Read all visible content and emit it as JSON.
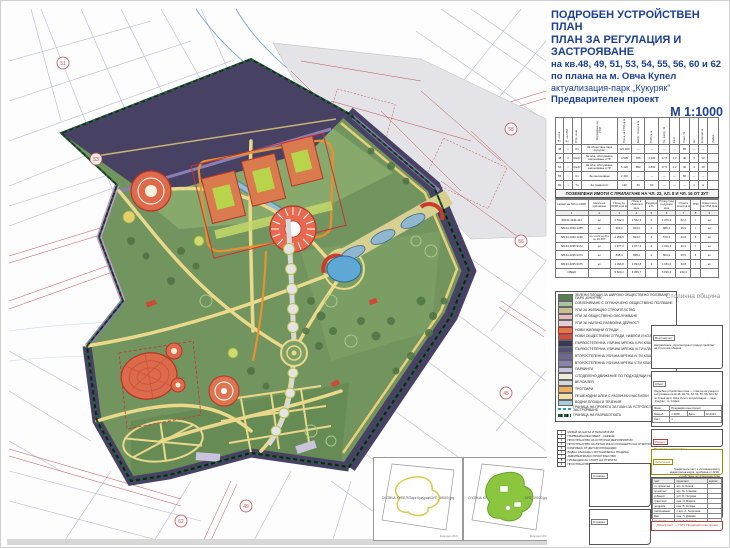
{
  "header": {
    "title_line1": "ПОДРОБЕН УСТРОЙСТВЕН ПЛАН",
    "title_line2": "ПЛАН ЗА РЕГУЛАЦИЯ И ЗАСТРОЯВАНЕ",
    "sub1": "на кв.48, 49, 51, 53, 54, 55, 56, 60 и 62",
    "sub2": "по плана на м. Овча Купел",
    "sub3": "актуализация-парк „Кукуряк“",
    "sub4": "Предварителен проект",
    "scale": "М 1:1000"
  },
  "municipality": "Столична община",
  "table1": {
    "headers": [
      "№ на кв.",
      "№ на УПИ",
      "Устр. зона",
      "Отреждане на УПИ",
      "Площ на УПИ кв.м",
      "Застр. площ кв.м",
      "РЗП кв.м",
      "Пл. застр. %",
      "Кинт",
      "Озел. %",
      "Ет.",
      "Н корниз м",
      "Забел."
    ],
    "rows": [
      [
        "48",
        "I",
        "Оз",
        "За обществен парк „Кукуряк“",
        "122 460",
        "—",
        "—",
        "—",
        "—",
        "85",
        "—",
        "—",
        ""
      ],
      [
        "48",
        "II",
        "Смф*",
        "За общ. обслужване, озеленяване и ПГ",
        "4 505",
        "785",
        "4 320",
        "17,5",
        "1,2",
        "40",
        "3",
        "10",
        ""
      ],
      [
        "54",
        "I",
        "Смф*",
        "За общ. обслужване, озеленяване и ПГ",
        "5 120",
        "890",
        "4 860",
        "17,5",
        "1,2",
        "40",
        "3",
        "10",
        ""
      ],
      [
        "55",
        "I",
        "Оз",
        "За озеленяване",
        "2 410",
        "—",
        "—",
        "—",
        "—",
        "80",
        "—",
        "—",
        ""
      ],
      [
        "60",
        "I",
        "Тп",
        "За трафопост",
        "120",
        "60",
        "60",
        "—",
        "—",
        "—",
        "1",
        "4",
        ""
      ],
      [
        "62",
        "I",
        "Оз",
        "За озеленяване и техн. инфраструктура",
        "980",
        "—",
        "—",
        "—",
        "—",
        "80",
        "—",
        "—",
        ""
      ]
    ]
  },
  "table2": {
    "title": "ПОЗЕМЛЕНИ ИМОТИ С ПРИЛАГАНЕ НА ЧЛ. 22, АЛ. 8 И ЧЛ. 16 ОТ ЗУТ",
    "headers": [
      "Номер на ПИ по КККР",
      "Начин на прилагане",
      "Площ по КККР в кв.м",
      "Площ в обхвата в кв.м",
      "Редукция в %",
      "Площ след редукция кв.м",
      "Отнета площ кв.м",
      "УПИ",
      "Нова площ на УПИ кв.м"
    ],
    "col_numbers": [
      "1",
      "2",
      "3",
      "4",
      "5",
      "6",
      "7",
      "8",
      "9"
    ],
    "rows": [
      [
        "68134.4334.421",
        "нл",
        "1 532,3",
        "1 532,3",
        "4",
        "1 470,1",
        "62,2",
        "I",
        "нл"
      ],
      [
        "68134.4334.1385",
        "нл",
        "923,0",
        "923,0",
        "4",
        "886,1",
        "36,9",
        "I",
        "нл"
      ],
      [
        "68134.4334.1249",
        "по чл.22 ал.8 и чл.16 ЗУТ",
        "4 354,5",
        "594,0",
        "4",
        "570,2",
        "23,8",
        "II",
        "нл"
      ],
      [
        "68134.4335.9472",
        "нл",
        "1 077,2",
        "1 077,2",
        "4",
        "1 034,1",
        "43,1",
        "I",
        "нл"
      ],
      [
        "68134.4335.9474",
        "нл",
        "838,4",
        "838,4",
        "4",
        "804,9",
        "33,5",
        "II",
        "нл"
      ],
      [
        "68134.4335.9475",
        "нл",
        "1 094,8",
        "1 094,8",
        "4",
        "1 051,0",
        "43,8",
        "I",
        "нл"
      ],
      [
        "ОБЩО",
        "",
        "9 820,2",
        "6 059,7",
        "",
        "5 816,4",
        "243,3",
        "",
        ""
      ]
    ]
  },
  "legend": {
    "items": [
      {
        "color": "#55804f",
        "label": "ЗЕЛЕНИ ПЛОЩИ ЗА ШИРОКО ОБЩЕСТВЕНО ПОЛЗВАНЕ - ПАРК „КУКУРЯК“"
      },
      {
        "color": "#a9c6a0",
        "label": "ОЗЕЛЕНЯВАНЕ С ОГРАНИЧЕНО ОБЩЕСТВЕНО ПОЛЗВАНЕ"
      },
      {
        "color": "#cbbf92",
        "label": "УПИ ЗА ЖИЛИЩНО СТРОИТЕЛСТВО"
      },
      {
        "color": "#e7bcbc",
        "label": "УПИ ЗА ОБЩЕСТВЕНО ОБСЛУЖВАНЕ"
      },
      {
        "color": "#e3cdd9",
        "label": "УПИ ЗА НАУЧНО-РАЗВОЙНА ДЕЙНОСТ"
      },
      {
        "color": "#d97b4f",
        "style": "bordered",
        "label": "НОВИ ЖИЛИЩНИ СГРАДИ"
      },
      {
        "color": "#dd4a38",
        "label": "НОВИ ОБЩЕСТВЕНИ СГРАДИ, НАВЕСИ И КОЗИРКИ"
      },
      {
        "color": "#3c3858",
        "label": "ПЪРВОСТЕПЕННА УЛИЧНА МРЕЖА II-РИ КЛАС"
      },
      {
        "color": "#55507a",
        "label": "ПЪРВОСТЕПЕННА УЛИЧНА МРЕЖА III-ТИ КЛАС"
      },
      {
        "color": "#6f6896",
        "label": "ВТОРОСТЕПЕННА УЛИЧНА МРЕЖА IV-ТИ КЛАС"
      },
      {
        "color": "#8b84ae",
        "label": "ВТОРОСТЕПЕННА УЛИЧНА МРЕЖА V-ТИ КЛАС"
      },
      {
        "color": "#cac3de",
        "label": "ПАРКИНГИ"
      },
      {
        "color": "#f0ecdc",
        "label": "СПОДЕЛЕНО ДВИЖЕНИЕ ПО ПОДХОДЯЩИ НАСТИЛКИ"
      },
      {
        "color": "#d8d8d8",
        "label": "ВЕЛОАЛЕЯ"
      },
      {
        "color": "#f0b060",
        "label": "ТРОТОАРИ"
      },
      {
        "color": "#f2e2a8",
        "label": "ПЕШЕХОДНИ АЛЕИ С РАЗЛИЧНИ НАСТИЛКИ"
      },
      {
        "color": "#a5cfe0",
        "label": "ВОДНИ ПЛОЩИ И ТЕЧЕНИЯ"
      },
      {
        "style": "dash-teal",
        "label": "ГРАНИЦА НА ПРОЕКТА ЗА ПЛАН ЗА УСТРОЙСТВО И ЗАСТРОЯВАНЕ"
      },
      {
        "style": "dash-green",
        "label": "ГРАНИЦА НА РАЗРАБОТКАТА"
      }
    ]
  },
  "objects": {
    "items": [
      {
        "num": "1",
        "label": "МУЗЕЙ ЗА НАУКА И ТЕХНОЛОГИИ"
      },
      {
        "num": "2",
        "label": "ПЪРВОНАЧАЛЕН ОБЕКТ - КАФЕНЕ"
      },
      {
        "num": "3",
        "label": "ПРОСТРАНСТВО ЗА КУЛТУРНИ МЕРОПРИЯТИЯ"
      },
      {
        "num": "4",
        "label": "ПРОСТРАНСТВО ЗА ЛЯТНО КИНО И КОНЦЕРТИ НА ОТКРИТО"
      },
      {
        "num": "5",
        "label": "КОМПЛЕКС ОТ ДЕТСКИ ПЛОЩАДКИ"
      },
      {
        "num": "6",
        "label": "ВОДНА КАСКАДА С БОТАНИЧЕСКА ГРАДИНА"
      },
      {
        "num": "7",
        "label": "АМФИТЕАТРАЛНО ПРОСТРАНСТВО"
      },
      {
        "num": "8",
        "label": "ПЛОЩАДКИ ЗА СПОРТ НА ОТКРИТО"
      },
      {
        "num": "9",
        "label": "ПРОСТРАНСТВО ЗА РАЗХОДКА НА ДОМАШНИ ЛЮБИМЦИ"
      }
    ]
  },
  "titleblock": {
    "client_label": "Възложител:",
    "client_line1": "Направление „Архитектура и градоустройство“",
    "client_line2": "на Столична община",
    "object_label": "Обект:",
    "object_text": "Подробен устройствен план — план за регулация и застрояване на кв.48, 49, 51, 53, 54, 55, 56, 60 и 62 по плана на м. Овча Купел, актуализация — парк „Кукуряк“, гр. София",
    "phase_label": "Фаза:",
    "phase": "Предварителен проект",
    "scale_label": "Мащаб",
    "scale": "1:1000",
    "date_label": "Дата",
    "date": "02.2021",
    "sheet_label": "Лист",
    "sheet": "1",
    "section_label": "Раздел:",
    "section": "Регулация и застрояване",
    "note_label": "Забележка:",
    "note_lines": [
      "Графичната част е изготвена върху",
      "кадастрална карта, одобрена от АГКК,",
      "и действащ регулационен план",
      "на м. Овча Купел"
    ],
    "sig_headers": [
      "част",
      "проектант",
      "подпис"
    ],
    "signatures": [
      {
        "role": "гл. проектант",
        "name": "арх. Н. Бонев"
      },
      {
        "role": "проектант",
        "name": "арх. М. Станева"
      },
      {
        "role": "урбанист",
        "name": "урб. Я. Петрова"
      },
      {
        "role": "транспорт",
        "name": "инж. И. Марков"
      },
      {
        "role": "геодезия",
        "name": "инж. В. Колева"
      },
      {
        "role": "озеленяване",
        "name": "л.арх. А. Георгиева"
      },
      {
        "role": "ВиК",
        "name": "инж. П. Димова"
      },
      {
        "role": "ел. схеми",
        "name": "инж. Б. Тодоров"
      }
    ],
    "red_note": "„Овча Купел“ — ПУП, Предварителен проект",
    "spravka1_label": "Справка:",
    "spravka2_label": "Справка:"
  },
  "insets": {
    "left_caption": "О:\\ОВЧА КУПЕЛ\\Парк Кукуряк\\ОУП_19000.jpg",
    "right_caption_left": "О:\\ОВЧА КУ",
    "right_caption_right": "ЗУП_19000.jpg",
    "left_footer": "Февруари 2021",
    "right_footer": "Февруари 2021"
  },
  "map": {
    "markers": [
      {
        "x": 62,
        "y": 62,
        "label": "51"
      },
      {
        "x": 95,
        "y": 158,
        "label": "53"
      },
      {
        "x": 510,
        "y": 128,
        "label": "58"
      },
      {
        "x": 520,
        "y": 240,
        "label": "56"
      },
      {
        "x": 505,
        "y": 392,
        "label": "45"
      },
      {
        "x": 420,
        "y": 520,
        "label": "47"
      },
      {
        "x": 245,
        "y": 505,
        "label": "49"
      },
      {
        "x": 180,
        "y": 520,
        "label": "62"
      }
    ]
  }
}
